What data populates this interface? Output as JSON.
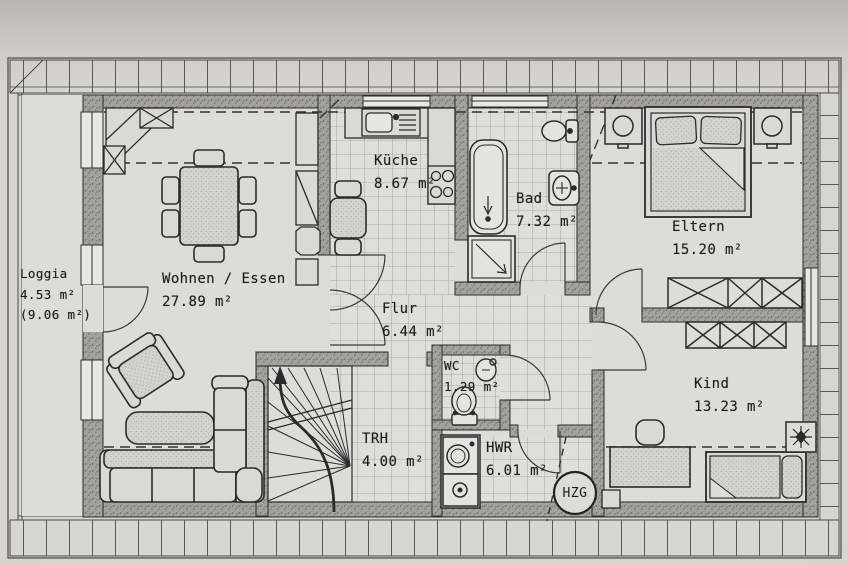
{
  "rooms": [
    {
      "name": "Loggia",
      "area": "4.53 m²",
      "area_alt": "(9.06 m²)"
    },
    {
      "name": "Wohnen / Essen",
      "area": "27.89 m²"
    },
    {
      "name": "Küche",
      "area": "8.67 m²"
    },
    {
      "name": "Bad",
      "area": "7.32 m²"
    },
    {
      "name": "Eltern",
      "area": "15.20 m²"
    },
    {
      "name": "Kind",
      "area": "13.23 m²"
    },
    {
      "name": "Flur",
      "area": "6.44 m²"
    },
    {
      "name": "WC",
      "area": "1.29 m²"
    },
    {
      "name": "TRH",
      "area": "4.00 m²"
    },
    {
      "name": "HWR",
      "area": "6.01 m²"
    }
  ],
  "symbols": {
    "heating_label": "HZG"
  },
  "colors": {
    "paper": "#d8d4cf",
    "ink": "#2b2b2b",
    "wall_fill": "#a5a19c",
    "tile": "#e1ddd8"
  }
}
